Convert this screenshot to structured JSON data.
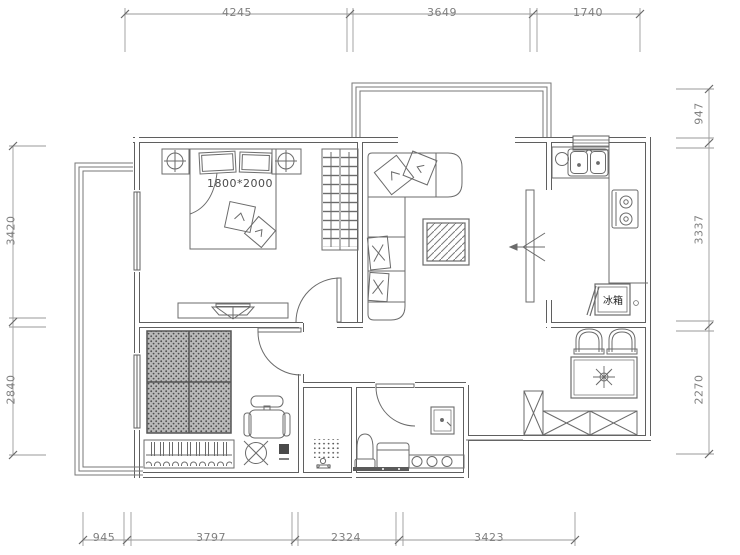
{
  "drawing": {
    "type": "apartment-floor-plan",
    "units": "mm"
  },
  "labels": {
    "bed_size": "1800*2000",
    "fridge": "冰箱"
  },
  "dims": {
    "top": [
      "4245",
      "3649",
      "1740"
    ],
    "bottom": [
      "945",
      "3797",
      "2324",
      "3423"
    ],
    "left": [
      "3420",
      "2840"
    ],
    "right": [
      "947",
      "3337",
      "2270"
    ]
  },
  "colors": {
    "wall_line": "#5f5f5f",
    "furniture_line": "#6b6b6b",
    "dimension_line": "#9a9a9a",
    "dimension_text": "#7f7f7f",
    "background": "#ffffff",
    "bed_hatch": "#b9b9b9"
  }
}
